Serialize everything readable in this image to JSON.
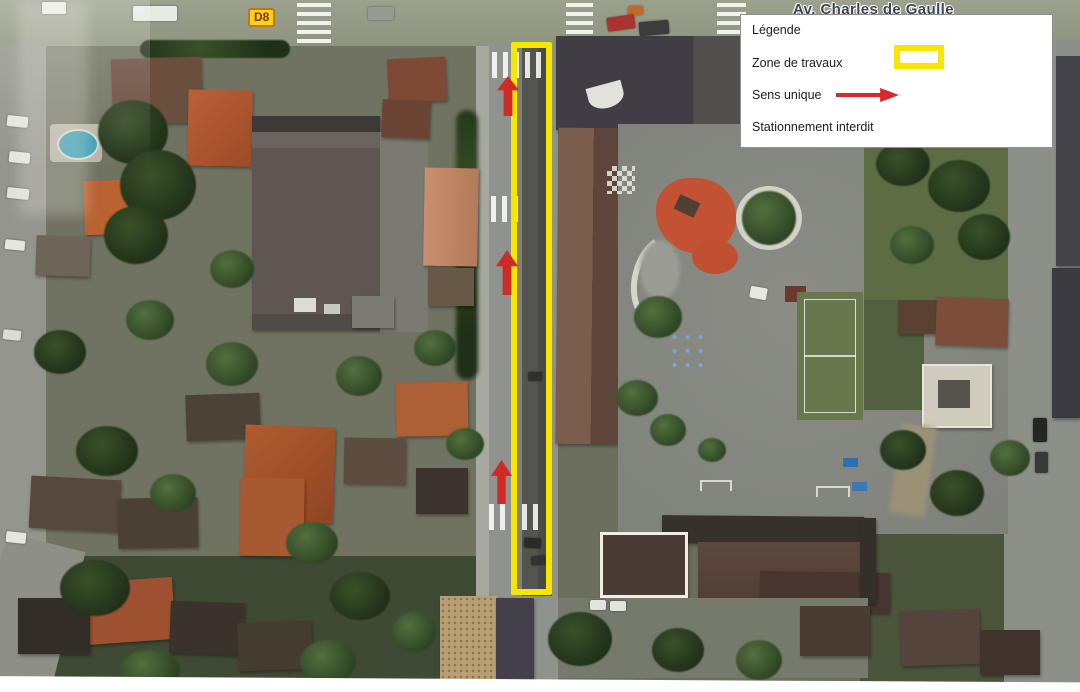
{
  "map": {
    "street_label": "Av. Charles de Gaulle",
    "road_sign": "D8"
  },
  "legend": {
    "title": "Légende",
    "items": [
      {
        "label": "Zone de travaux",
        "icon": "work-zone-swatch",
        "color": "#f8e600"
      },
      {
        "label": "Sens unique",
        "icon": "one-way-arrow-swatch",
        "color": "#d8282c"
      },
      {
        "label": "Stationnement interdit",
        "icon": "",
        "color": ""
      }
    ]
  },
  "annotations": {
    "work_zone_color": "#f8e600",
    "one_way_arrow_color": "#d02a26",
    "arrow_direction": "up",
    "arrow_count": 3
  }
}
